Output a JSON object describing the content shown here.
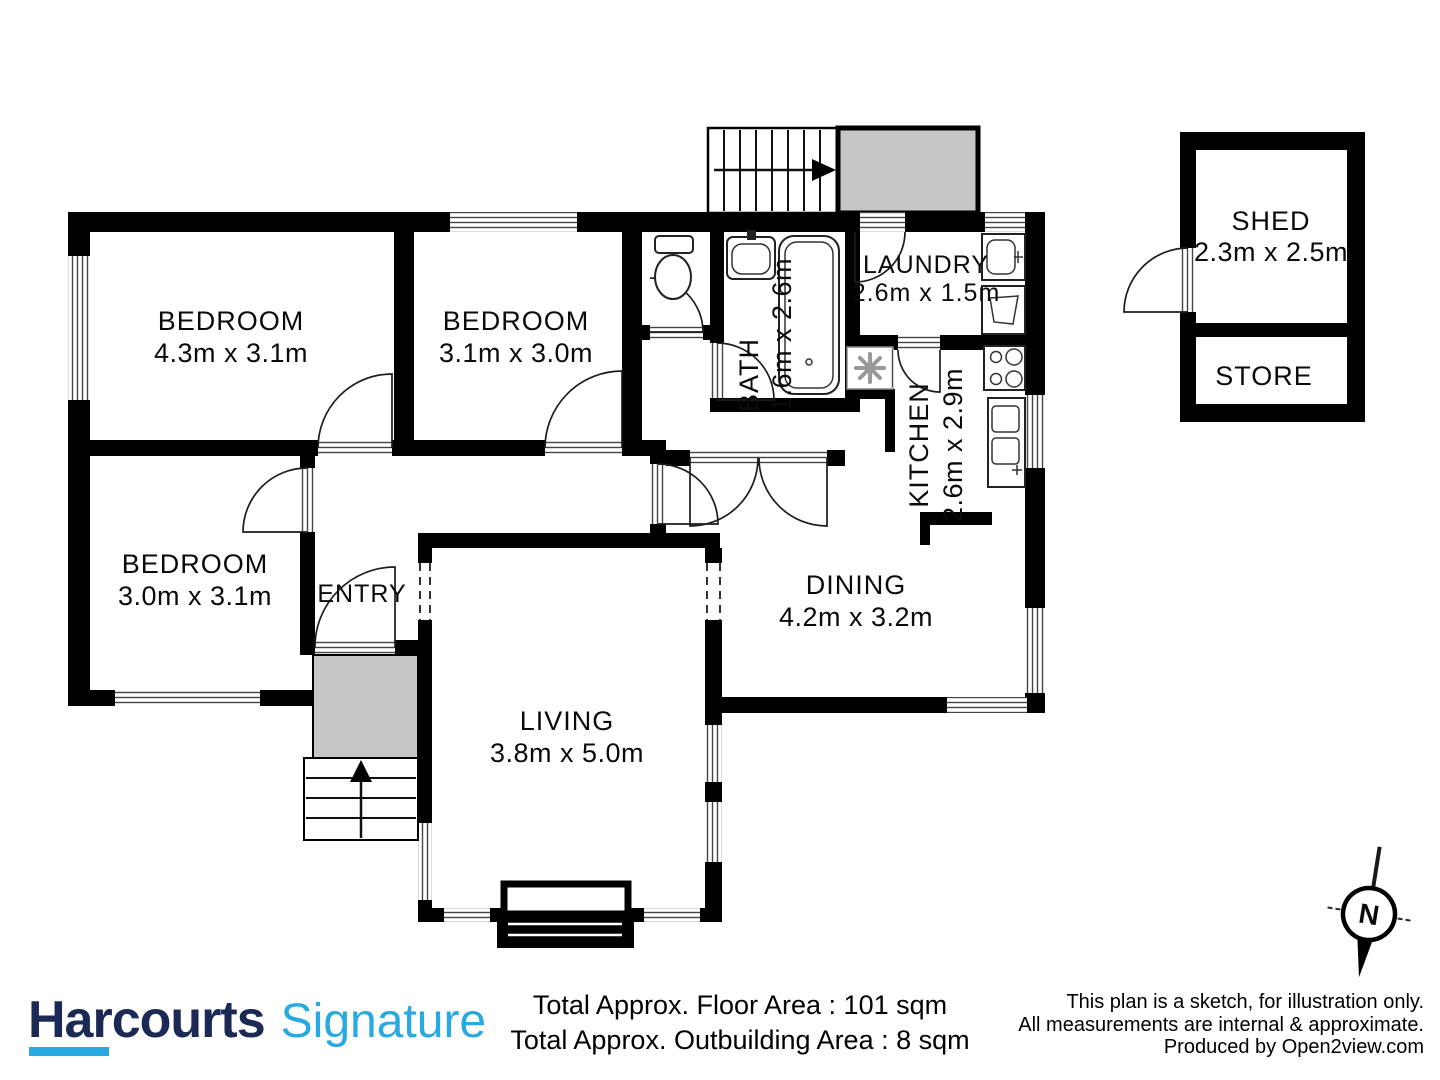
{
  "plan": {
    "rooms": {
      "bedroom1": {
        "name": "BEDROOM",
        "dims": "4.3m x 3.1m"
      },
      "bedroom2": {
        "name": "BEDROOM",
        "dims": "3.1m x 3.0m"
      },
      "bedroom3": {
        "name": "BEDROOM",
        "dims": "3.0m x 3.1m"
      },
      "entry": {
        "name": "ENTRY"
      },
      "living": {
        "name": "LIVING",
        "dims": "3.8m x 5.0m"
      },
      "dining": {
        "name": "DINING",
        "dims": "4.2m x 3.2m"
      },
      "kitchen": {
        "name": "KITCHEN",
        "dims": "2.6m x 2.9m"
      },
      "bath": {
        "name": "BATH",
        "dims": "1.6m x 2.6m"
      },
      "laundry": {
        "name": "LAUNDRY",
        "dims": "2.6m x 1.5m"
      },
      "shed": {
        "name": "SHED",
        "dims": "2.3m x 2.5m"
      },
      "store": {
        "name": "STORE"
      }
    },
    "compass": {
      "label": "N"
    },
    "colors": {
      "wall": "#000000",
      "porch_fill": "#c6c6c6"
    }
  },
  "footer": {
    "brand": {
      "primary": "Harcourts",
      "secondary": "Signature",
      "primary_color": "#1b2a55",
      "secondary_color": "#29a9e1"
    },
    "areas": {
      "line1": "Total Approx. Floor Area : 101 sqm",
      "line2": "Total Approx. Outbuilding Area : 8 sqm"
    },
    "disclaimer": {
      "line1": "This plan is a sketch, for illustration only.",
      "line2": "All measurements are internal & approximate.",
      "line3": "Produced by Open2view.com"
    }
  }
}
